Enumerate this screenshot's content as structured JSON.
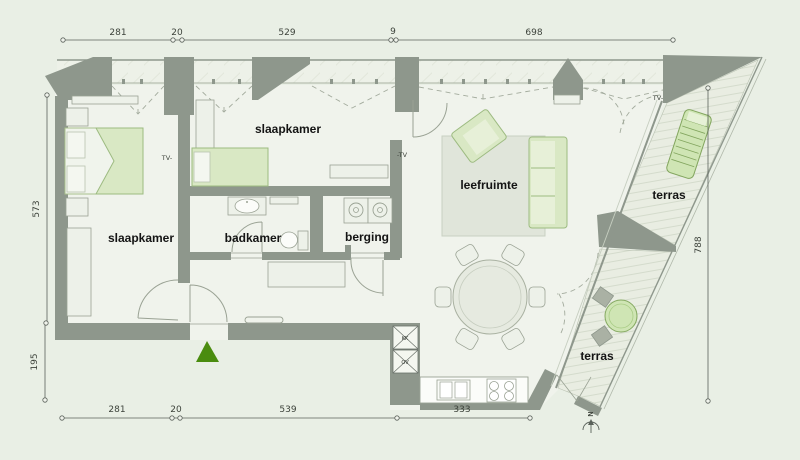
{
  "plan": {
    "colors": {
      "background": "#e9efe5",
      "floor": "#f0f3ec",
      "wall": "#8e978c",
      "furniture_green": "#d9e8c4",
      "furniture_green_border": "#9dbb81",
      "accent_green": "#4a8c0f",
      "dimension_line": "#5a615a"
    },
    "rooms": {
      "bedroom_left": "slaapkamer",
      "bedroom_mid": "slaapkamer",
      "bathroom": "badkamer",
      "storage": "berging",
      "living": "leefruimte",
      "terrace_upper": "terras",
      "terrace_lower": "terras"
    },
    "markers": {
      "tv_bedroom": "TV-",
      "tv_living": "-TV",
      "tv_terrace": "TV-",
      "fridge": "KK",
      "oven": "OV",
      "north": "N"
    },
    "dimensions": {
      "top": [
        "281",
        "20",
        "529",
        "9",
        "698"
      ],
      "bottom": [
        "281",
        "20",
        "539",
        "333"
      ],
      "left": [
        "573",
        "195"
      ],
      "right": [
        "788"
      ]
    }
  }
}
